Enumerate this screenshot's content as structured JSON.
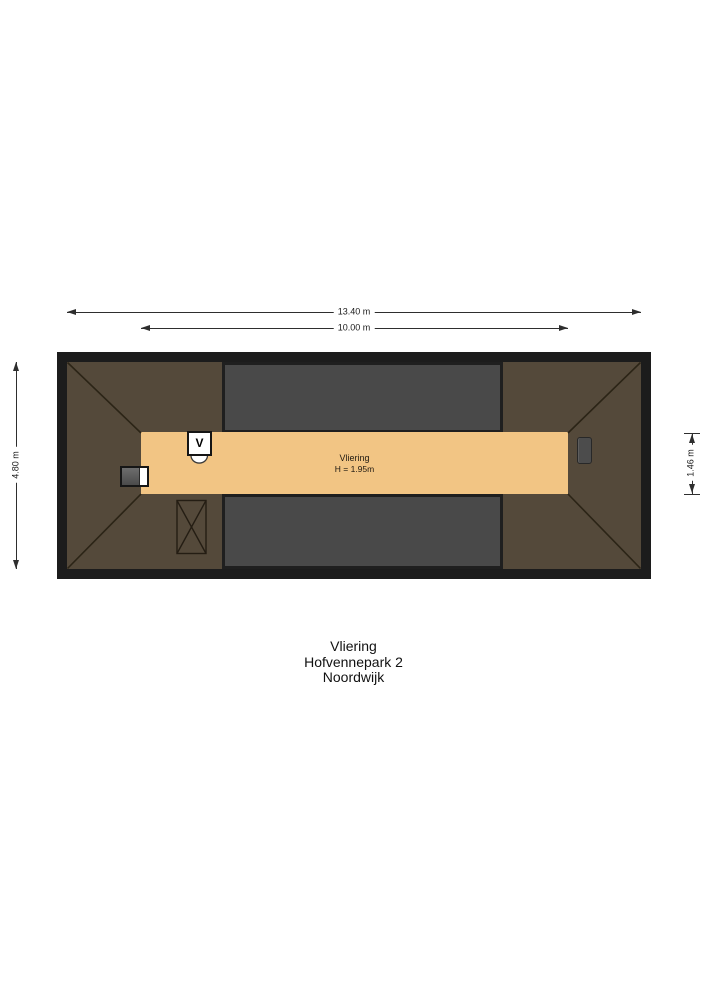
{
  "dimensions": {
    "overall_width": "13.40 m",
    "floor_width": "10.00 m",
    "overall_depth": "4.80 m",
    "floor_depth": "1.46 m"
  },
  "room": {
    "name": "Vliering",
    "height_note": "H = 1.95m"
  },
  "symbols": {
    "ventilation": "V"
  },
  "footer": {
    "line1": "Vliering",
    "line2": "Hofvennepark 2",
    "line3": "Noordwijk"
  },
  "colors": {
    "frame": "#1c1c1c",
    "roof": "#54493a",
    "floor": "#f2c584",
    "dormer": "#494949",
    "dimension_line": "#2e2e2e",
    "background": "#ffffff"
  }
}
